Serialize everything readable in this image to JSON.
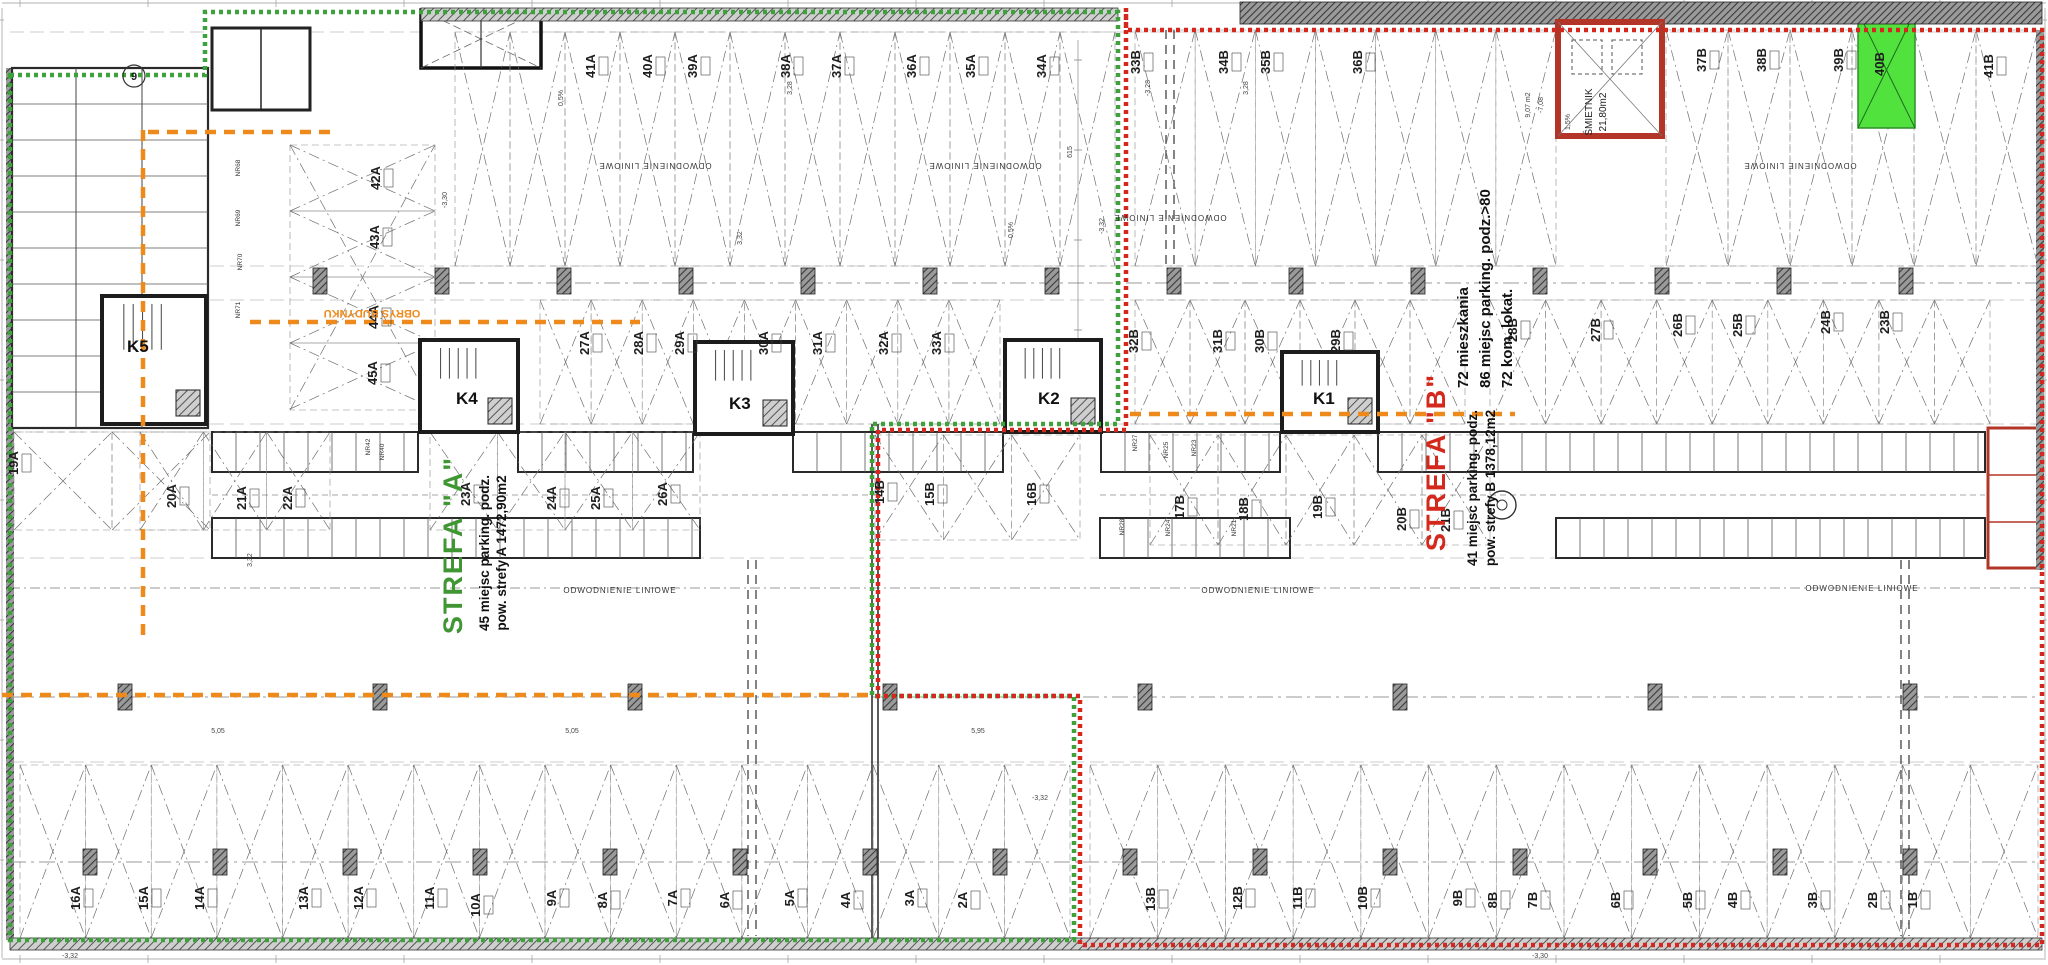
{
  "plan": {
    "strefa_a": {
      "name": "STREFA \"A\"",
      "line1": "45 miejsc parking. podz.",
      "line2": "pow. strefy A 1472,90m2"
    },
    "strefa_b": {
      "name": "STREFA \"B\"",
      "line1": "41 miejsc parking. podz.",
      "line2": "pow. strefy B 1378,12m2"
    },
    "stats": [
      "72 mieszkania",
      "86 miejsc parking. podz.>80",
      "72 kom. lokat."
    ],
    "outline_label": "OBRYS BUDYNKU",
    "drainage_label": "ODWODNIENIE LINIOWE",
    "smietnik_name": "ŚMIETNIK",
    "smietnik_area": "21,80m2",
    "room_area_note": "9,07 m2",
    "room_level_note": "-7,08",
    "axis_bubble": "9",
    "highlight_space": "40B",
    "colors": {
      "zone_a_green": "#3da23c",
      "zone_b_red": "#d4281e",
      "outline_orange": "#ee8a1c",
      "strefa_a_text": "#3f9633",
      "strefa_b_text": "#d5281c",
      "highlight_fill": "#52e23e",
      "line_dark": "#222222",
      "line_light": "#8a8a8a"
    },
    "cores": [
      {
        "label": "K5",
        "x": 127,
        "y": 352,
        "bx": 102,
        "by": 296,
        "bw": 104,
        "bh": 128
      },
      {
        "label": "K4",
        "x": 456,
        "y": 404,
        "bx": 420,
        "by": 340,
        "bw": 98,
        "bh": 92
      },
      {
        "label": "K3",
        "x": 729,
        "y": 409,
        "bx": 695,
        "by": 342,
        "bw": 98,
        "bh": 92
      },
      {
        "label": "K2",
        "x": 1038,
        "y": 404,
        "bx": 1005,
        "by": 340,
        "bw": 96,
        "bh": 92
      },
      {
        "label": "K1",
        "x": 1313,
        "y": 404,
        "bx": 1282,
        "by": 352,
        "bw": 96,
        "bh": 80
      }
    ],
    "parking_labels": {
      "row_top_a": [
        [
          "41A",
          595,
          66
        ],
        [
          "40A",
          652,
          66
        ],
        [
          "39A",
          697,
          66
        ],
        [
          "38A",
          790,
          66
        ],
        [
          "37A",
          841,
          66
        ],
        [
          "36A",
          916,
          66
        ],
        [
          "35A",
          975,
          66
        ],
        [
          "34A",
          1046,
          66
        ]
      ],
      "row_top_b": [
        [
          "33B",
          1140,
          62
        ],
        [
          "34B",
          1228,
          62
        ],
        [
          "35B",
          1270,
          62
        ],
        [
          "36B",
          1362,
          62
        ],
        [
          "37B",
          1706,
          60
        ],
        [
          "38B",
          1766,
          60
        ],
        [
          "39B",
          1843,
          60
        ],
        [
          "41B",
          1993,
          66
        ]
      ],
      "row_mid_a": [
        [
          "27A",
          589,
          343
        ],
        [
          "28A",
          643,
          343
        ],
        [
          "29A",
          684,
          343
        ],
        [
          "30A",
          768,
          343
        ],
        [
          "31A",
          822,
          343
        ],
        [
          "32A",
          888,
          343
        ],
        [
          "33A",
          941,
          343
        ]
      ],
      "row_mid_b": [
        [
          "32B",
          1138,
          341
        ],
        [
          "31B",
          1222,
          341
        ],
        [
          "30B",
          1264,
          341
        ],
        [
          "29B",
          1340,
          341
        ],
        [
          "28B",
          1517,
          330
        ],
        [
          "27B",
          1600,
          330
        ],
        [
          "26B",
          1682,
          325
        ],
        [
          "25B",
          1742,
          325
        ],
        [
          "24B",
          1830,
          322
        ],
        [
          "23B",
          1889,
          322
        ]
      ],
      "col_left_a": [
        [
          "42A",
          380,
          178
        ],
        [
          "43A",
          379,
          237
        ],
        [
          "44A",
          378,
          317
        ],
        [
          "45A",
          377,
          373
        ]
      ],
      "row_low_a": [
        [
          "19A",
          18,
          463
        ],
        [
          "20A",
          176,
          496
        ],
        [
          "21A",
          246,
          498
        ],
        [
          "22A",
          292,
          498
        ],
        [
          "23A",
          470,
          494
        ],
        [
          "24A",
          556,
          498
        ],
        [
          "25A",
          600,
          498
        ],
        [
          "26A",
          667,
          494
        ]
      ],
      "row_low_b": [
        [
          "14B",
          884,
          492
        ],
        [
          "15B",
          934,
          494
        ],
        [
          "16B",
          1036,
          494
        ],
        [
          "17B",
          1184,
          507
        ],
        [
          "18B",
          1248,
          509
        ],
        [
          "19B",
          1322,
          507
        ],
        [
          "20B",
          1406,
          519
        ],
        [
          "21B",
          1450,
          520
        ]
      ],
      "row_bottom_a": [
        [
          "16A",
          80,
          898
        ],
        [
          "15A",
          148,
          898
        ],
        [
          "14A",
          204,
          898
        ],
        [
          "13A",
          308,
          898
        ],
        [
          "12A",
          363,
          898
        ],
        [
          "11A",
          434,
          898
        ],
        [
          "10A",
          480,
          905
        ],
        [
          "9A",
          556,
          898
        ],
        [
          "8A",
          607,
          900
        ],
        [
          "7A",
          677,
          898
        ],
        [
          "6A",
          729,
          900
        ],
        [
          "5A",
          794,
          898
        ],
        [
          "4A",
          850,
          900
        ],
        [
          "3A",
          914,
          898
        ],
        [
          "2A",
          967,
          900
        ]
      ],
      "row_bottom_b": [
        [
          "13B",
          1155,
          899
        ],
        [
          "12B",
          1242,
          898
        ],
        [
          "11B",
          1302,
          898
        ],
        [
          "10B",
          1367,
          898
        ],
        [
          "9B",
          1462,
          898
        ],
        [
          "8B",
          1497,
          900
        ],
        [
          "7B",
          1537,
          900
        ],
        [
          "6B",
          1620,
          900
        ],
        [
          "5B",
          1692,
          900
        ],
        [
          "4B",
          1737,
          900
        ],
        [
          "3B",
          1817,
          900
        ],
        [
          "2B",
          1877,
          900
        ],
        [
          "1B",
          1917,
          900
        ]
      ]
    },
    "storage_labels": [
      [
        "NR68",
        240,
        168
      ],
      [
        "NR69",
        240,
        218
      ],
      [
        "NR70",
        242,
        262
      ],
      [
        "NR71",
        240,
        310
      ],
      [
        "NR42",
        370,
        447
      ],
      [
        "NR40",
        384,
        452
      ],
      [
        "NR27",
        1137,
        443
      ],
      [
        "NR25",
        1168,
        450
      ],
      [
        "NR23",
        1196,
        448
      ],
      [
        "NR28",
        1124,
        527
      ],
      [
        "NR24",
        1170,
        528
      ],
      [
        "NR21",
        1236,
        528
      ]
    ],
    "dim_labels": [
      {
        "t": "-3,30",
        "x": 447,
        "y": 200
      },
      {
        "t": "3,28",
        "x": 792,
        "y": 88
      },
      {
        "t": "-3,28",
        "x": 1150,
        "y": 88
      },
      {
        "t": "3,32",
        "x": 742,
        "y": 238
      },
      {
        "t": "-3,32",
        "x": 1104,
        "y": 226
      },
      {
        "t": "615",
        "x": 1072,
        "y": 152
      },
      {
        "t": "0,5%",
        "x": 563,
        "y": 98
      },
      {
        "t": "0,5%",
        "x": 1013,
        "y": 230
      },
      {
        "t": "1,5%",
        "x": 1570,
        "y": 122
      },
      {
        "t": "5,05",
        "x": 218,
        "y": 733,
        "r": 0
      },
      {
        "t": "5,05",
        "x": 572,
        "y": 733,
        "r": 0
      },
      {
        "t": "5,95",
        "x": 978,
        "y": 733,
        "r": 0
      },
      {
        "t": "-3,32",
        "x": 70,
        "y": 958,
        "r": 0
      },
      {
        "t": "-3,30",
        "x": 1540,
        "y": 958,
        "r": 0
      },
      {
        "t": "3,32",
        "x": 252,
        "y": 560
      },
      {
        "t": "-3,32",
        "x": 1040,
        "y": 800,
        "r": 0
      },
      {
        "t": "3,28",
        "x": 1248,
        "y": 88
      }
    ],
    "drain_positions": [
      {
        "x": 655,
        "y": 163,
        "r": 180
      },
      {
        "x": 985,
        "y": 163,
        "r": 180
      },
      {
        "x": 1170,
        "y": 215,
        "r": 180
      },
      {
        "x": 1800,
        "y": 163,
        "r": 180
      },
      {
        "x": 620,
        "y": 593,
        "r": 0
      },
      {
        "x": 1258,
        "y": 593,
        "r": 0
      },
      {
        "x": 1862,
        "y": 591,
        "r": 0
      }
    ]
  }
}
